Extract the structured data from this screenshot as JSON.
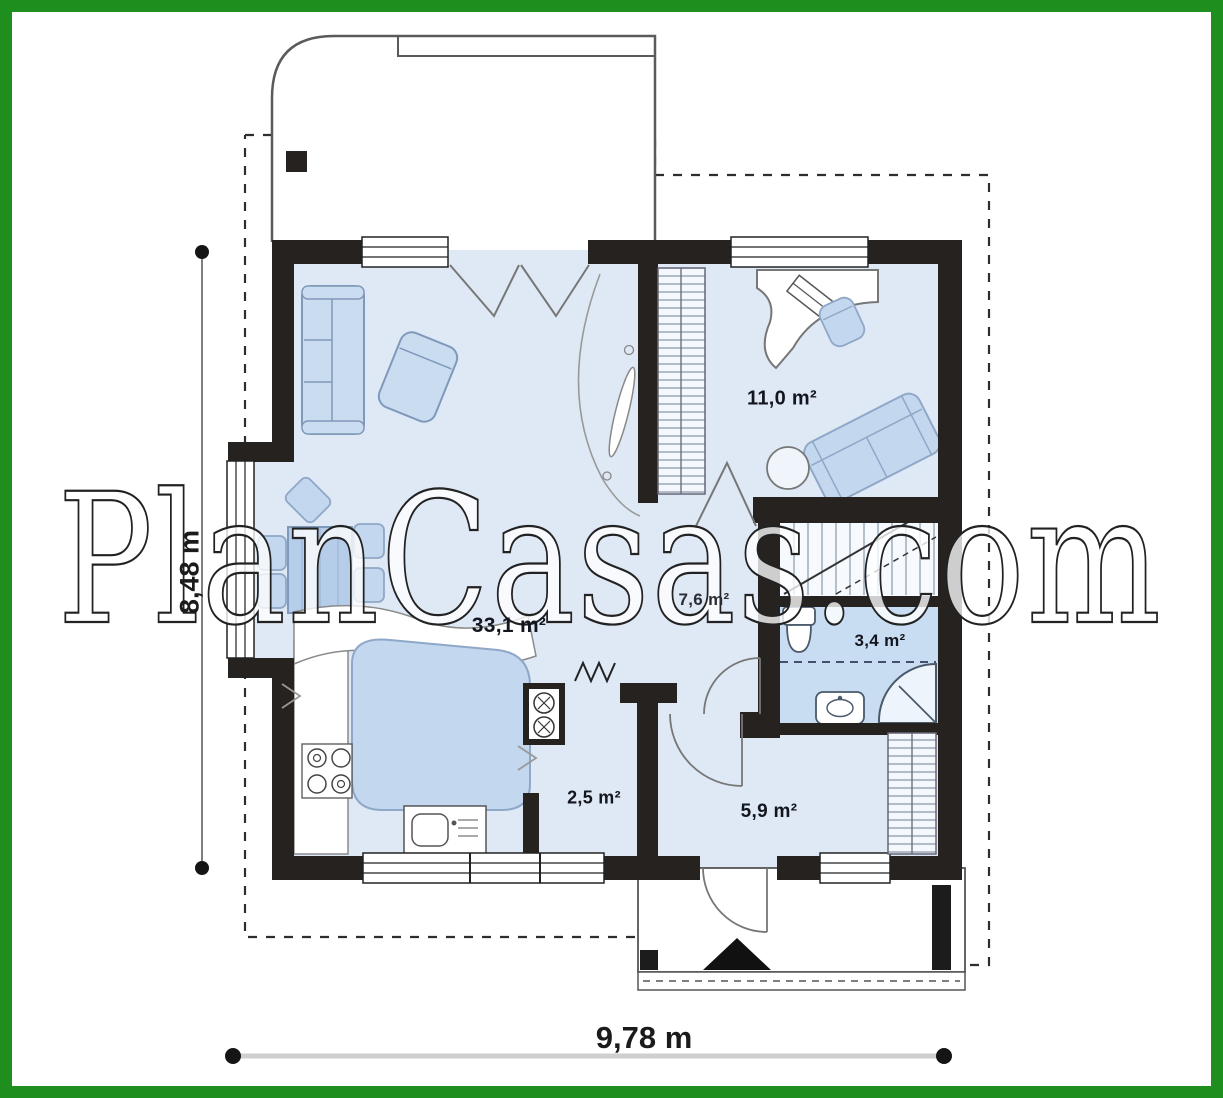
{
  "watermark": {
    "text": "PlanCasas.com"
  },
  "plan": {
    "rooms": [
      {
        "id": "living-dining-kitchen",
        "area_label": "33,1 m²"
      },
      {
        "id": "office-bedroom",
        "area_label": "11,0 m²"
      },
      {
        "id": "hall",
        "area_label": "7,6 m²"
      },
      {
        "id": "bathroom",
        "area_label": "3,4 m²"
      },
      {
        "id": "pantry",
        "area_label": "2,5 m²"
      },
      {
        "id": "entrance-hall",
        "area_label": "5,9 m²"
      }
    ],
    "dimensions": {
      "width_label": "9,78 m",
      "height_label": "8,48 m"
    },
    "colors": {
      "frame_green": "#1e8e1e",
      "wall_black": "#262220",
      "floor_blue": "#dfe9f5",
      "bathroom_floor": "#c9ddf2",
      "furniture_blue": "#c3d7ee"
    }
  }
}
